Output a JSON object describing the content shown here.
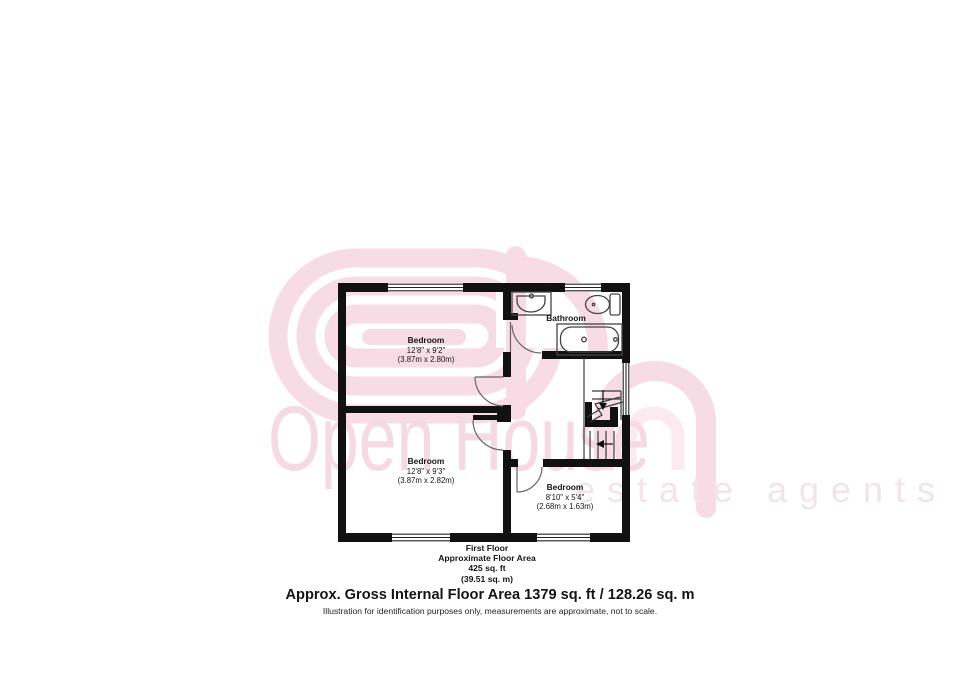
{
  "watermark": {
    "brand": "Open House",
    "tagline": "estate agents",
    "color_primary": "#f7dce5",
    "color_light": "#fbeaf0"
  },
  "plan": {
    "rooms": [
      {
        "name": "Bedroom",
        "dims": "12'8\" x 9'2\"",
        "dims_metric": "(3.87m x 2.80m)"
      },
      {
        "name": "Bathroom",
        "dims": "",
        "dims_metric": ""
      },
      {
        "name": "Bedroom",
        "dims": "12'8\" x 9'3\"",
        "dims_metric": "(3.87m x 2.82m)"
      },
      {
        "name": "Bedroom",
        "dims": "8'10\" x 5'4\"",
        "dims_metric": "(2.68m x 1.63m)"
      }
    ]
  },
  "caption": {
    "floor": "First Floor",
    "area_label": "Approximate Floor Area",
    "area_imperial": "425 sq. ft",
    "area_metric": "(39.51 sq. m)"
  },
  "footer": {
    "title": "Approx. Gross Internal Floor Area 1379 sq. ft / 128.26 sq. m",
    "disclaimer": "Illustration for identification purposes only, measurements are approximate, not to scale."
  }
}
